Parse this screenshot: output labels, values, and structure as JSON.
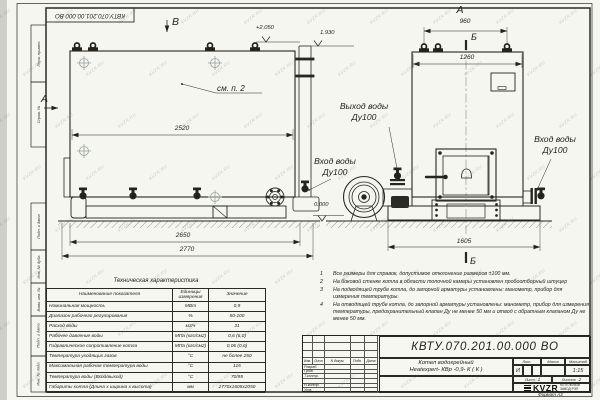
{
  "doc_number": "КВТУ.070.201.00.000  ВО",
  "watermark": {
    "text": "KVZR.RU"
  },
  "stamp_column": {
    "items": [
      "Перв. примен.",
      "Справ. №",
      "Подп. и дата",
      "Инв. № дубл.",
      "Взам. инв. №",
      "Подп. и дата",
      "Инв. № подл."
    ]
  },
  "views": {
    "side": {
      "label_b": "В",
      "label_a": "А",
      "see_note": "см. п. 2",
      "elev_top": "+2.050",
      "elev_flue": "1.930",
      "dim_body": "2520",
      "dim_base": "2650",
      "dim_overall": "2770"
    },
    "front": {
      "label_a": "А",
      "label_b_top": "Б",
      "label_b_bottom": "Б",
      "dim_lugs": "960",
      "dim_width": "1260",
      "dim_overall": "1605",
      "elev_zero": "0.000",
      "port_out": {
        "line1": "Выход воды",
        "line2": "Ду100"
      },
      "port_in_left": {
        "line1": "Вход воды",
        "line2": "Ду100"
      },
      "port_in_right": {
        "line1": "Вход воды",
        "line2": "Ду100"
      }
    }
  },
  "notes": [
    {
      "num": "1",
      "text": "Все размеры для справок, допустимое отклонение размеров ±100 мм."
    },
    {
      "num": "2",
      "text": "На боковой стенке котла в области топочной камеры установлен пробоотборный штуцер"
    },
    {
      "num": "3",
      "text": "На  подводящей трубе котла, до запорной арматуры установлены: манометр, прибор для измерения температуры."
    },
    {
      "num": "4",
      "text": "На отводящей трубе котла, до запорной арматуры установлены: манометр, прибор для измерения температуры, предохранительный клапан Ду не менее 50 мм и отвод с обратным клапаном Ду не менее 50 мм."
    }
  ],
  "tech_table": {
    "title": "Техническая характеристика",
    "headers": [
      "Наименование показателя",
      "Единицы измерения",
      "Значение"
    ],
    "rows": [
      [
        "Номинальная мощность",
        "МВт",
        "0,9"
      ],
      [
        "Диапазон рабочего регулирования",
        "%",
        "50-100"
      ],
      [
        "Расход воды",
        "м3/ч",
        "31"
      ],
      [
        "Рабочее давление воды",
        "МПа (кгс/см2)",
        "0,6 (6,0)"
      ],
      [
        "Гидравлическое сопротивление котла",
        "МПа (кгс/см2)",
        "0,06 (0,6)"
      ],
      [
        "Температура уходящих газов",
        "°С",
        "не более 250"
      ],
      [
        "Максимальная рабочая температура воды",
        "°С",
        "115"
      ],
      [
        "Температура воды (Вход/выход)",
        "°С",
        "70/95"
      ],
      [
        "Габариты котла (Длина х ширина х высота)",
        "мм",
        "2770х1605х2050"
      ]
    ]
  },
  "title_block": {
    "doc_number": "КВТУ.070.201.00.000  ВО",
    "name_line1": "Котел водогрейный",
    "name_line2": "Heatexpert- КВр -0,9- К ( К )",
    "header_cols": [
      "Изм.",
      "Лист",
      "N докум.",
      "Подп.",
      "Дата"
    ],
    "role_rows": [
      "Разраб.",
      "Пров.",
      "Т.контр.",
      "",
      "Н.контр.",
      "Утв."
    ],
    "lit_header": "Лит.",
    "lit_value": "И",
    "mass_header": "Масса",
    "scale_header": "Масштаб",
    "scale_value": "1:15",
    "sheet_label": "Лист",
    "sheet_value": "1",
    "sheets_label": "Листов",
    "sheets_value": "2",
    "logo_text": "KVZR",
    "company_line1": "КОТЕЛЬНЫЙ",
    "company_line2": "ЗАВОД РЭП",
    "format_label": "Формат  А3"
  }
}
